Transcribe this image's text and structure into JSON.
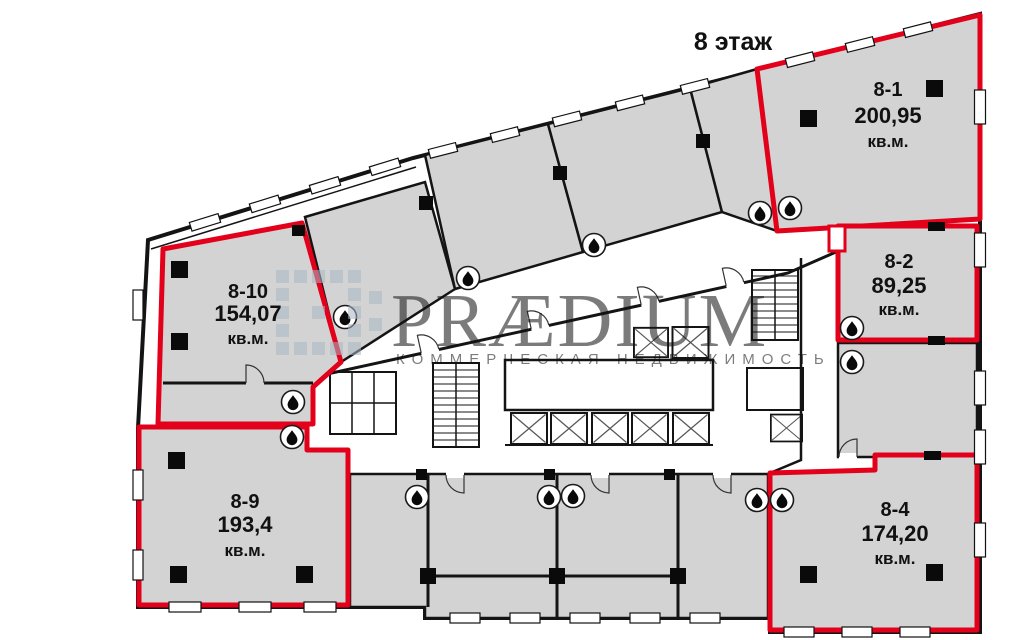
{
  "floor": {
    "title": "8 этаж"
  },
  "watermark": {
    "brand": "PRÆDIUM",
    "tagline": "КОММЕРЧЕСКАЯ НЕДВИЖИМОСТЬ",
    "color": "#a9b6c6"
  },
  "colors": {
    "available_outline": "#e2001a",
    "room_fill": "#d3d3d3",
    "wall": "#141414"
  },
  "icons": {
    "water_drop": "water-drop-in-circle"
  },
  "rooms": {
    "available": [
      {
        "id": "8-1",
        "area": "200,95",
        "unit": "кв.м."
      },
      {
        "id": "8-2",
        "area": "89,25",
        "unit": "кв.м."
      },
      {
        "id": "8-4",
        "area": "174,20",
        "unit": "кв.м."
      },
      {
        "id": "8-9",
        "area": "193,4",
        "unit": "кв.м."
      },
      {
        "id": "8-10",
        "area": "154,07",
        "unit": "кв.м."
      }
    ]
  }
}
